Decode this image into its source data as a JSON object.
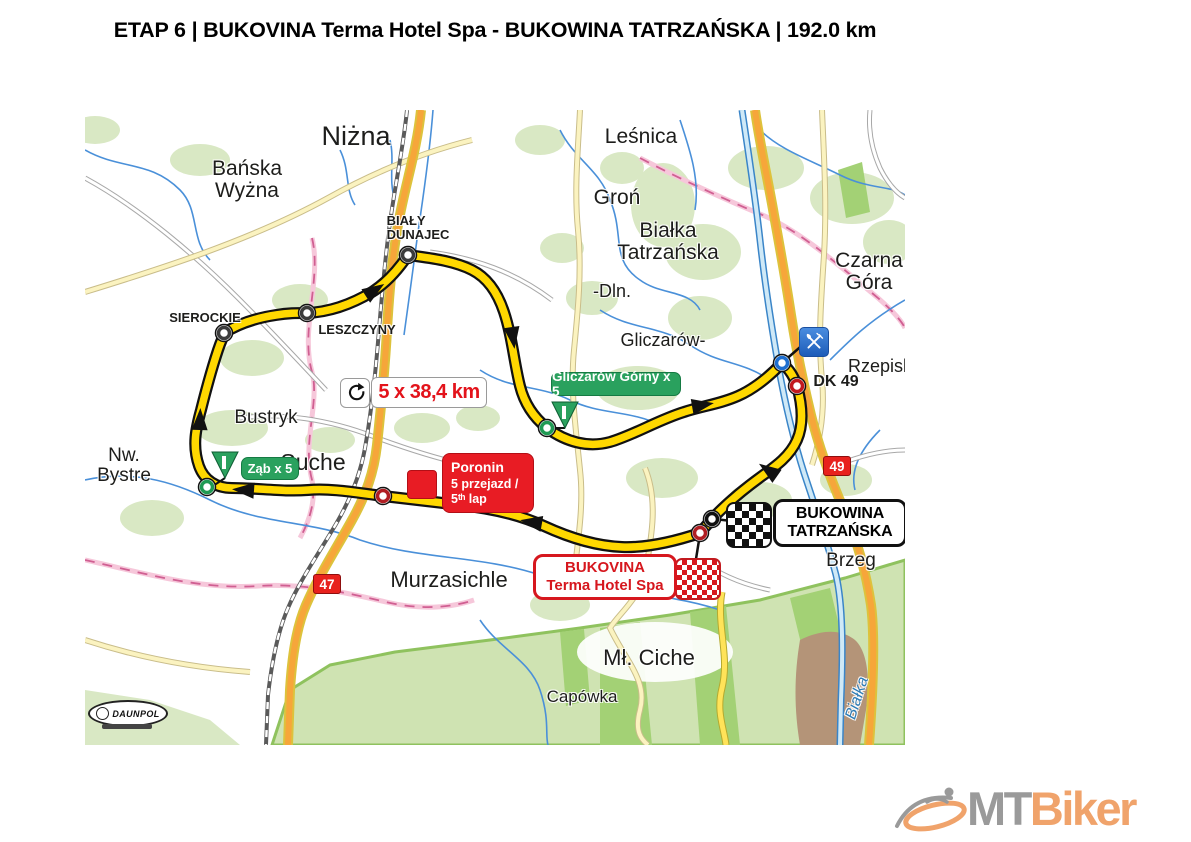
{
  "title": "ETAP 6 | BUKOVINA Terma Hotel Spa - BUKOWINA TATRZAŃSKA | 192.0 km",
  "map": {
    "lap_badge": {
      "icon": "loop-arrow",
      "text": "5 x 38,4 km"
    },
    "climb_labels": [
      {
        "id": "gliczarow-gorny",
        "text": "Gliczarów Górny x 5"
      },
      {
        "id": "zab",
        "text": "Ząb x 5"
      }
    ],
    "checkpoint_labels": {
      "poronin": {
        "lines": [
          "Poronin",
          "5 przejazd /",
          "5ᵗʰ lap"
        ]
      },
      "finish": {
        "lines": [
          "BUKOWINA",
          "TATRZAŃSKA"
        ]
      },
      "start": {
        "lines": [
          "BUKOVINA",
          "Terma Hotel Spa"
        ]
      }
    },
    "road_shields": [
      {
        "text": "47"
      },
      {
        "text": "49"
      }
    ],
    "places": [
      {
        "id": "nizna",
        "text": "Niżna",
        "x": 356,
        "y": 122,
        "fs": 27
      },
      {
        "id": "banska-wyzna",
        "lines": [
          "Bańska",
          "Wyżna"
        ],
        "x": 247,
        "y": 158,
        "fs": 21
      },
      {
        "id": "bialy-dunajec",
        "lines": [
          "BIAŁY",
          "DUNAJEC"
        ],
        "x": 418,
        "y": 214,
        "fs": 13,
        "bold": true,
        "anchor": "left"
      },
      {
        "id": "lesnica",
        "text": "Leśnica",
        "x": 641,
        "y": 126,
        "fs": 21
      },
      {
        "id": "gron",
        "text": "Groń",
        "x": 617,
        "y": 187,
        "fs": 21
      },
      {
        "id": "bialka-tatrzanska",
        "lines": [
          "Białka",
          "Tatrzańska"
        ],
        "x": 668,
        "y": 220,
        "fs": 21
      },
      {
        "id": "czarna-gora",
        "lines": [
          "Czarna",
          "Góra"
        ],
        "x": 869,
        "y": 250,
        "fs": 21
      },
      {
        "id": "dln",
        "text": "-Dln.",
        "x": 612,
        "y": 282,
        "fs": 18
      },
      {
        "id": "gliczarow",
        "text": "Gliczarów-",
        "x": 663,
        "y": 331,
        "fs": 18
      },
      {
        "id": "rzepiska",
        "text": "Rzepiska",
        "x": 885,
        "y": 357,
        "fs": 18
      },
      {
        "id": "bustryk",
        "text": "Bustryk",
        "x": 266,
        "y": 408,
        "fs": 19
      },
      {
        "id": "nw-bystre",
        "lines": [
          "Nw.",
          "Bystre"
        ],
        "x": 124,
        "y": 446,
        "fs": 19
      },
      {
        "id": "suche",
        "text": "Suche",
        "x": 313,
        "y": 450,
        "fs": 23
      },
      {
        "id": "murzasichle",
        "text": "Murzasichle",
        "x": 449,
        "y": 568,
        "fs": 22
      },
      {
        "id": "brzeg",
        "text": "Brzeg",
        "x": 851,
        "y": 551,
        "fs": 19
      },
      {
        "id": "ml-ciche",
        "text": "Mł. Ciche",
        "x": 649,
        "y": 646,
        "fs": 22
      },
      {
        "id": "capowka",
        "text": "Capówka",
        "x": 582,
        "y": 688,
        "fs": 17
      },
      {
        "id": "sierockie",
        "text": "SIEROCKIE",
        "x": 205,
        "y": 311,
        "fs": 13,
        "bold": true
      },
      {
        "id": "leszczyny",
        "text": "LESZCZYNY",
        "x": 357,
        "y": 323,
        "fs": 13,
        "bold": true
      },
      {
        "id": "dk-49",
        "text": "DK 49",
        "x": 836,
        "y": 374,
        "fs": 16,
        "bold": true
      },
      {
        "id": "bialka-river",
        "text": "Białka",
        "x": 858,
        "y": 690,
        "fs": 16,
        "italic": true,
        "color": "#2e7cb5",
        "rotate": -72
      }
    ]
  },
  "logos": {
    "daunpol": "DAUNPOL",
    "mtbiker": {
      "mt": "MT",
      "biker": "Biker"
    }
  },
  "colors": {
    "route_yellow": "#FFD800",
    "climb_green": "#2aa15e",
    "marker_red": "#e81c24",
    "shield_red": "#e8211d",
    "mtbiker_orange": "#f0a36b",
    "mtbiker_gray": "#9a9a9a"
  }
}
